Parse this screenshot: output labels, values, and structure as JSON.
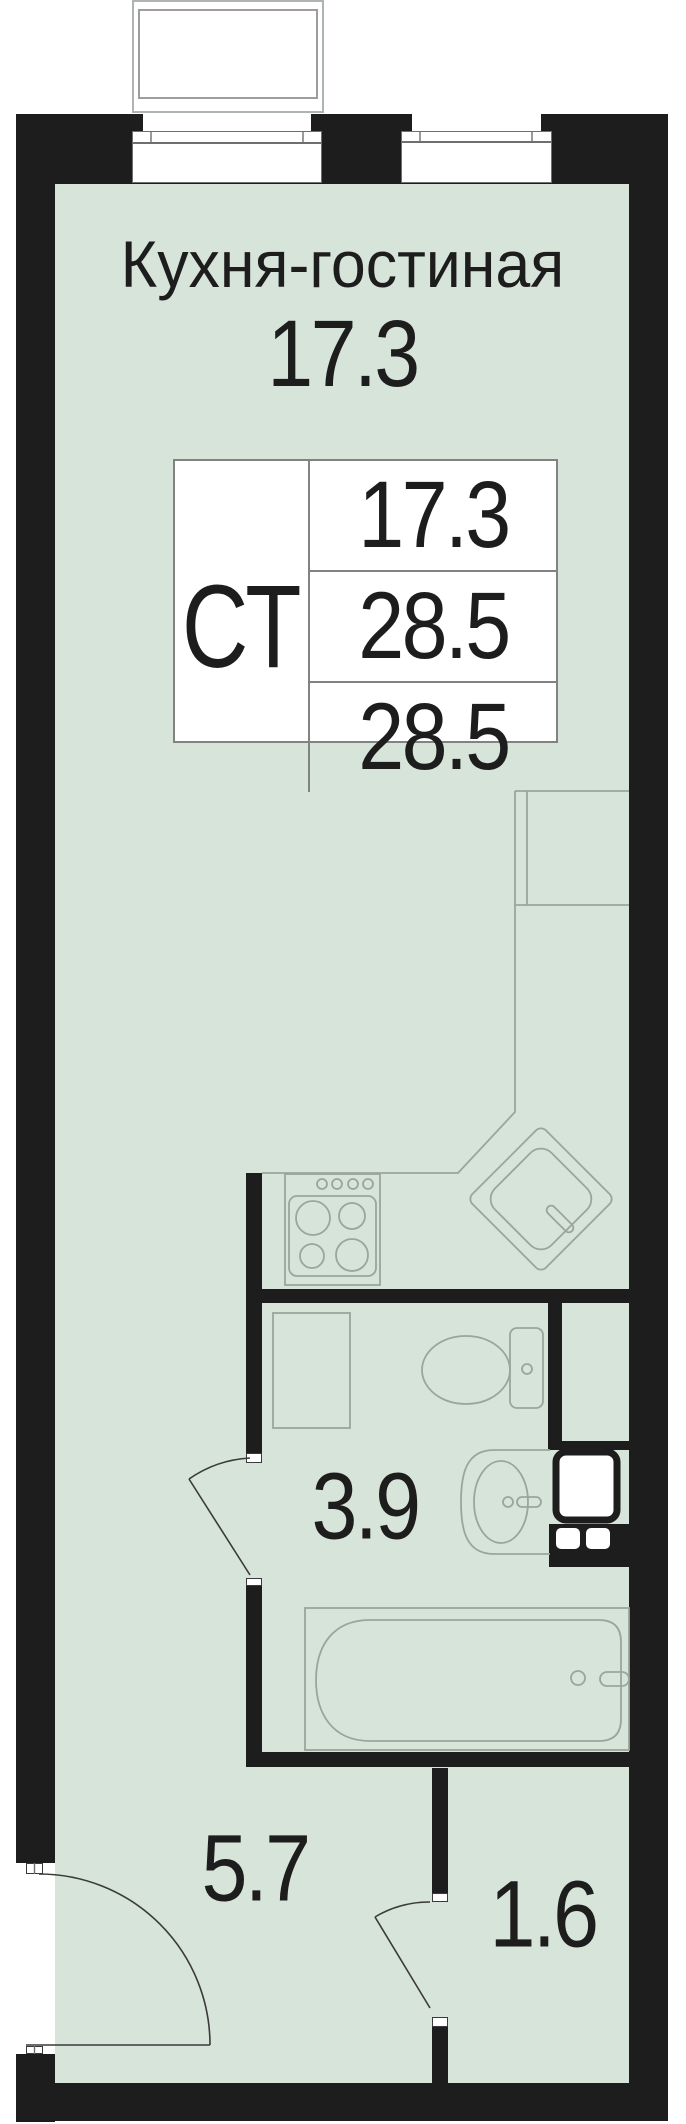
{
  "plan": {
    "room_title": "Кухня-гостиная",
    "room_area": "17.3",
    "info_table": {
      "apartment_type": "СТ",
      "values": [
        "17.3",
        "28.5",
        "28.5"
      ]
    },
    "area_labels": {
      "bathroom": "3.9",
      "hallway": "5.7",
      "entry": "1.6"
    },
    "colors": {
      "floor": "#d7e4da",
      "wall": "#1d1d1d",
      "fixture_line": "#9aa59c",
      "text": "#1d1d1d"
    },
    "fixtures": [
      "balcony",
      "window-left",
      "window-right",
      "kitchen-counter",
      "kitchen-sink",
      "stove",
      "cabinet",
      "toilet",
      "bathroom-sink",
      "washing-machine",
      "bathtub",
      "entrance-door",
      "bathroom-door",
      "hall-door"
    ]
  }
}
